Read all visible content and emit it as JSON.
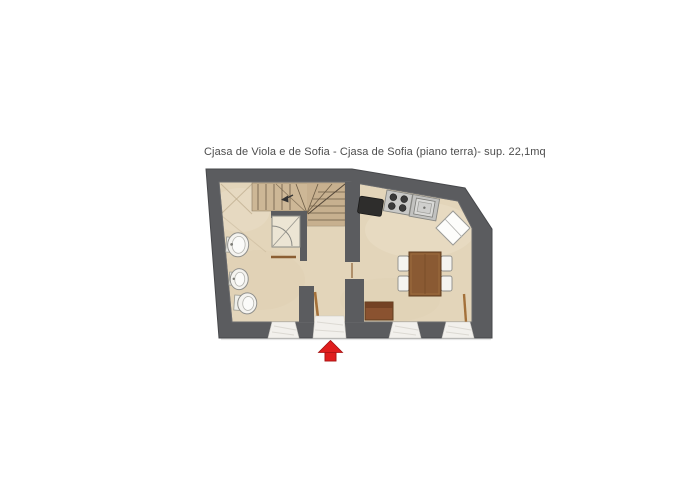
{
  "page": {
    "background": "#ffffff"
  },
  "floor_plan": {
    "title": "Cjasa de Viola e de Sofia - Cjasa de Sofia (piano terra)- sup. 22,1mq",
    "property_name": "Cjasa de Viola e de Sofia",
    "unit_name": "Cjasa de Sofia",
    "level": "piano terra",
    "surface": "sup. 22,1mq",
    "colors": {
      "wall": "#5b5c5f",
      "floor": "#e3d5ba",
      "stair_wood": "#cdb796",
      "furniture_wood": "#8a5a33",
      "fixture_white": "#f4f3ef",
      "marble_threshold": "#f2f0ec",
      "entrance_arrow": "#e01d1d"
    },
    "elements": [
      "staircase",
      "shower",
      "washbasin",
      "bidet",
      "toilet",
      "kitchen-appliance",
      "stove",
      "kitchen-sink",
      "dining-table",
      "chairs",
      "bench",
      "entrance-door",
      "door-openings",
      "entrance-arrow"
    ]
  }
}
